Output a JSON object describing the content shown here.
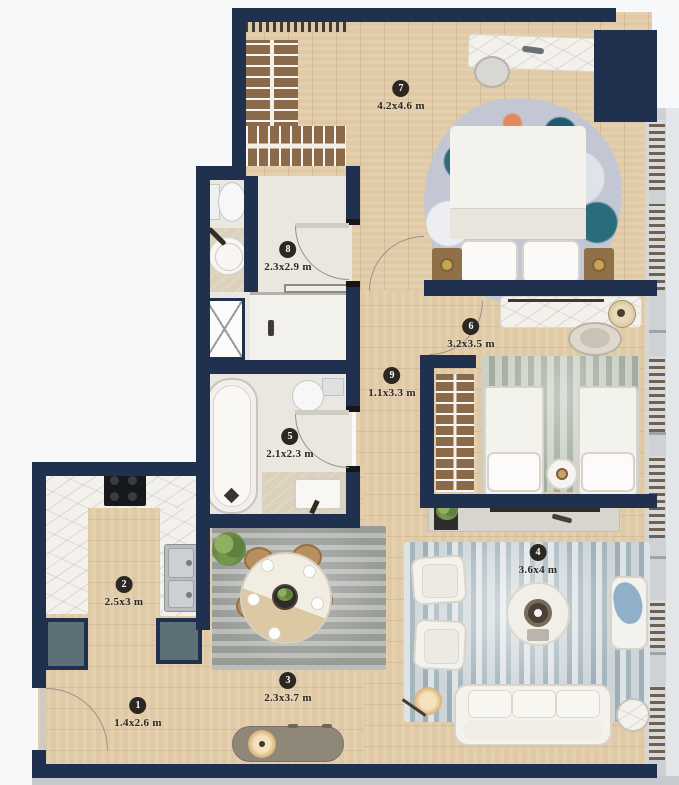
{
  "plan": {
    "title": "apartment-floor-plan",
    "rooms": [
      {
        "number": "1",
        "dimensions": "1.4x2.6 m",
        "name": "entry"
      },
      {
        "number": "2",
        "dimensions": "2.5x3 m",
        "name": "kitchen"
      },
      {
        "number": "3",
        "dimensions": "2.3x3.7 m",
        "name": "dining"
      },
      {
        "number": "4",
        "dimensions": "3.6x4 m",
        "name": "living"
      },
      {
        "number": "5",
        "dimensions": "2.1x2.3 m",
        "name": "bathroom-small"
      },
      {
        "number": "6",
        "dimensions": "3.2x3.5 m",
        "name": "bedroom-second"
      },
      {
        "number": "7",
        "dimensions": "4.2x4.6 m",
        "name": "bedroom-master"
      },
      {
        "number": "8",
        "dimensions": "2.3x2.9 m",
        "name": "bathroom-main"
      },
      {
        "number": "9",
        "dimensions": "1.1x3.3 m",
        "name": "hallway"
      }
    ],
    "colors": {
      "wall": "#20304f",
      "wood_floor": "#e4cda9",
      "bath_floor": "#eae7e0",
      "living_rug": "#bcc7cc",
      "label_bg": "#2b2723",
      "label_text": "#ffffff",
      "accent_teal": "#5d7077",
      "wardrobe_wood": "#8a6a49"
    }
  }
}
